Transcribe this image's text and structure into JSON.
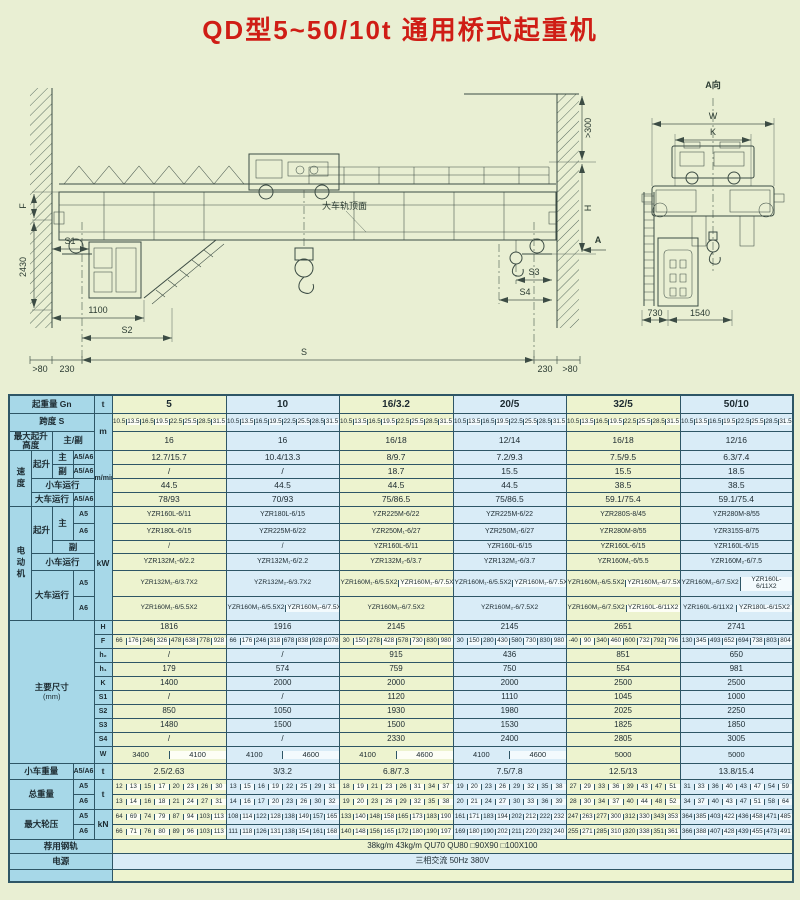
{
  "title": "QD型5~50/10t 通用桥式起重机",
  "colors": {
    "accent_red": "#cf1d15",
    "table_border": "#2e5666",
    "header_bg": "#a7d8e8",
    "green_cell": "#edf3cf",
    "blue_cell": "#d9ecf7",
    "page_bg": "#e9efd3"
  },
  "drawing": {
    "elevation": {
      "f": "F",
      "h2430": "2430",
      "s1": "S1",
      "d1100": "1100",
      "s2": "S2",
      "gt80_left": ">80",
      "d230_left": "230",
      "span": "S",
      "d230_right": "230",
      "gt80_right": ">80",
      "gt300": ">300",
      "h": "H",
      "s3": "S3",
      "s4": "S4",
      "view_arrow": "A",
      "rail_note": "大车轨顶面"
    },
    "aview": {
      "label": "A向",
      "w": "W",
      "k": "K",
      "d730": "730",
      "d1540": "1540"
    }
  },
  "table": {
    "capacity": {
      "label": "起重量 Gn",
      "unit": "t",
      "values": [
        "5",
        "10",
        "16/3.2",
        "20/5",
        "32/5",
        "50/10"
      ]
    },
    "span": {
      "label": "跨度 S",
      "unit": "m",
      "values": [
        [
          "10.5",
          "13.5",
          "16.5",
          "19.5",
          "22.5",
          "25.5",
          "28.5",
          "31.5"
        ],
        [
          "10.5",
          "13.5",
          "16.5",
          "19.5",
          "22.5",
          "25.5",
          "28.5",
          "31.5"
        ],
        [
          "10.5",
          "13.5",
          "16.5",
          "19.5",
          "22.5",
          "25.5",
          "28.5",
          "31.5"
        ],
        [
          "10.5",
          "13.5",
          "16.5",
          "19.5",
          "22.5",
          "25.5",
          "28.5",
          "31.5"
        ],
        [
          "10.5",
          "13.5",
          "16.5",
          "19.5",
          "22.5",
          "25.5",
          "28.5",
          "31.5"
        ],
        [
          "10.5",
          "13.5",
          "16.5",
          "19.5",
          "22.5",
          "25.5",
          "28.5",
          "31.5"
        ]
      ]
    },
    "height": {
      "label": "最大起升高度",
      "sublabel": "主/副",
      "values": [
        "16",
        "16",
        "16/18",
        "12/14",
        "16/18",
        "12/16"
      ]
    },
    "speed": {
      "label": "速度",
      "unit": "m/min",
      "hoist": "起升",
      "main": "主",
      "aux": "副",
      "a56": "A5/A6",
      "trolley": "小车运行",
      "bridge": "大车运行",
      "main_values": [
        "12.7/15.7",
        "10.4/13.3",
        "8/9.7",
        "7.2/9.3",
        "7.5/9.5",
        "6.3/7.4"
      ],
      "aux_values": [
        "/",
        "/",
        "18.7",
        "15.5",
        "15.5",
        "18.5"
      ],
      "trolley_values": [
        "44.5",
        "44.5",
        "44.5",
        "44.5",
        "38.5",
        "38.5"
      ],
      "bridge_values": [
        "78/93",
        "70/93",
        "75/86.5",
        "75/86.5",
        "59.1/75.4",
        "59.1/75.4"
      ]
    },
    "motor": {
      "label": "电动机",
      "unit": "kW",
      "hoist": "起升",
      "main": "主",
      "aux": "副",
      "a5": "A5",
      "a6": "A6",
      "trolley": "小车运行",
      "bridge": "大车运行",
      "main_a5": [
        "YZR160L-6/11",
        "YZR180L-6/15",
        "YZR225M-6/22",
        "YZR225M-6/22",
        "YZR280S-8/45",
        "YZR280M-8/55"
      ],
      "main_a6": [
        "YZR180L-6/15",
        "YZR225M-6/22",
        "YZR250M₁-6/27",
        "YZR250M₁-6/27",
        "YZR280M-8/55",
        "YZR315S-8/75"
      ],
      "aux_values": [
        "/",
        "/",
        "YZR160L-6/11",
        "YZR160L-6/15",
        "YZR160L-6/15",
        "YZR160L-6/15"
      ],
      "trolley_values": [
        "YZR132M₁-6/2.2",
        "YZR132M₁-6/2.2",
        "YZR132M₂-6/3.7",
        "YZR132M₂-6/3.7",
        "YZR160M₁-6/5.5",
        "YZR160M₂-6/7.5"
      ],
      "bridge_a5": [
        [
          "YZR132M₂-6/3.7X2"
        ],
        [
          "YZR132M₂-6/3.7X2"
        ],
        [
          "YZR160M₁-6/5.5X2",
          "YZR160M₁-6/7.5X2"
        ],
        [
          "YZR160M₁-6/5.5X2",
          "YZR160M₁-6/7.5X2"
        ],
        [
          "YZR160M₁-6/5.5X2",
          "YZR160M₂-6/7.5X2"
        ],
        [
          "YZR160M₂-6/7.5X2",
          "YZR160L-6/11X2"
        ]
      ],
      "bridge_a6": [
        [
          "YZR160M₁-6/5.5X2"
        ],
        [
          "YZR160M₁-6/5.5X2",
          "YZR160M₂-6/7.5X2"
        ],
        [
          "YZR160M₂-6/7.5X2"
        ],
        [
          "YZR160M₂-6/7.5X2"
        ],
        [
          "YZR160M₂-6/7.5X2",
          "YZR160L-6/11X2"
        ],
        [
          "YZR160L-6/11X2",
          "YZR180L-6/15X2"
        ]
      ]
    },
    "dims": {
      "label": "主要尺寸",
      "unit": "(mm)",
      "letters": [
        "H",
        "F",
        "h₂",
        "h₁",
        "K",
        "S1",
        "S2",
        "S3",
        "S4",
        "W"
      ],
      "H": [
        "1816",
        "1916",
        "2145",
        "2145",
        "2651",
        "2741"
      ],
      "F": [
        [
          "66",
          "176",
          "246",
          "326",
          "478",
          "638",
          "778",
          "928"
        ],
        [
          "66",
          "176",
          "246",
          "318",
          "678",
          "838",
          "928",
          "1078"
        ],
        [
          "30",
          "150",
          "278",
          "428",
          "578",
          "730",
          "830",
          "980"
        ],
        [
          "30",
          "150",
          "280",
          "430",
          "580",
          "730",
          "830",
          "980"
        ],
        [
          "-40",
          "90",
          "340",
          "460",
          "600",
          "732",
          "792",
          "796"
        ],
        [
          "130",
          "345",
          "493",
          "652",
          "694",
          "738",
          "803",
          "804"
        ]
      ],
      "h2": [
        "/",
        "/",
        "915",
        "436",
        "851",
        "650"
      ],
      "h1": [
        "179",
        "574",
        "759",
        "750",
        "554",
        "981"
      ],
      "K": [
        "1400",
        "2000",
        "2000",
        "2000",
        "2500",
        "2500"
      ],
      "S1": [
        "/",
        "/",
        "1120",
        "1110",
        "1045",
        "1000"
      ],
      "S2": [
        "850",
        "1050",
        "1930",
        "1980",
        "2025",
        "2250"
      ],
      "S3": [
        "1480",
        "1500",
        "1500",
        "1530",
        "1825",
        "1850"
      ],
      "S4": [
        "/",
        "/",
        "2330",
        "2400",
        "2805",
        "3005"
      ],
      "W": [
        [
          "3400",
          "4100"
        ],
        [
          "4100",
          "4600"
        ],
        [
          "4100",
          "4600"
        ],
        [
          "4100",
          "4600"
        ],
        [
          "5000"
        ],
        [
          "5000"
        ]
      ]
    },
    "trolley_weight": {
      "label": "小车重量",
      "a56": "A5/A6",
      "unit": "t",
      "values": [
        "2.5/2.63",
        "3/3.2",
        "6.8/7.3",
        "7.5/7.8",
        "12.5/13",
        "13.8/15.4"
      ]
    },
    "total_weight": {
      "label": "总重量",
      "unit": "t",
      "a5": "A5",
      "a6": "A6",
      "a5_values": [
        [
          "12",
          "13",
          "15",
          "17",
          "20",
          "23",
          "26",
          "30"
        ],
        [
          "13",
          "15",
          "16",
          "19",
          "22",
          "25",
          "29",
          "31"
        ],
        [
          "18",
          "19",
          "21",
          "23",
          "26",
          "31",
          "34",
          "37"
        ],
        [
          "19",
          "20",
          "23",
          "26",
          "29",
          "32",
          "35",
          "38"
        ],
        [
          "27",
          "29",
          "33",
          "36",
          "39",
          "43",
          "47",
          "51"
        ],
        [
          "31",
          "33",
          "36",
          "40",
          "43",
          "47",
          "54",
          "59"
        ]
      ],
      "a6_values": [
        [
          "13",
          "14",
          "16",
          "18",
          "21",
          "24",
          "27",
          "31"
        ],
        [
          "14",
          "16",
          "17",
          "20",
          "23",
          "26",
          "30",
          "32"
        ],
        [
          "19",
          "20",
          "23",
          "26",
          "29",
          "32",
          "35",
          "38"
        ],
        [
          "20",
          "21",
          "24",
          "27",
          "30",
          "33",
          "36",
          "39"
        ],
        [
          "28",
          "30",
          "34",
          "37",
          "40",
          "44",
          "48",
          "52"
        ],
        [
          "34",
          "37",
          "40",
          "43",
          "47",
          "51",
          "58",
          "64"
        ]
      ]
    },
    "wheel_load": {
      "label": "最大轮压",
      "unit": "kN",
      "a5": "A5",
      "a6": "A6",
      "a5_values": [
        [
          "64",
          "69",
          "74",
          "79",
          "87",
          "94",
          "103",
          "113"
        ],
        [
          "108",
          "114",
          "122",
          "128",
          "138",
          "149",
          "157",
          "165"
        ],
        [
          "133",
          "140",
          "148",
          "158",
          "165",
          "173",
          "183",
          "190"
        ],
        [
          "161",
          "171",
          "183",
          "194",
          "202",
          "212",
          "222",
          "232"
        ],
        [
          "247",
          "263",
          "277",
          "300",
          "312",
          "330",
          "343",
          "353"
        ],
        [
          "364",
          "385",
          "403",
          "422",
          "436",
          "458",
          "471",
          "485"
        ]
      ],
      "a6_values": [
        [
          "66",
          "71",
          "76",
          "80",
          "89",
          "96",
          "103",
          "113"
        ],
        [
          "111",
          "118",
          "126",
          "131",
          "138",
          "154",
          "161",
          "168"
        ],
        [
          "140",
          "148",
          "156",
          "165",
          "172",
          "180",
          "190",
          "197"
        ],
        [
          "169",
          "180",
          "190",
          "202",
          "211",
          "220",
          "232",
          "240"
        ],
        [
          "255",
          "271",
          "285",
          "310",
          "320",
          "338",
          "351",
          "361"
        ],
        [
          "366",
          "388",
          "407",
          "428",
          "439",
          "455",
          "473",
          "491"
        ]
      ]
    },
    "rail": {
      "label": "荐用钢轨",
      "value": "38kg/m  43kg/m  QU70  QU80  □90X90  □100X100"
    },
    "power": {
      "label": "电源",
      "value": "三相交流  50Hz  380V"
    }
  }
}
